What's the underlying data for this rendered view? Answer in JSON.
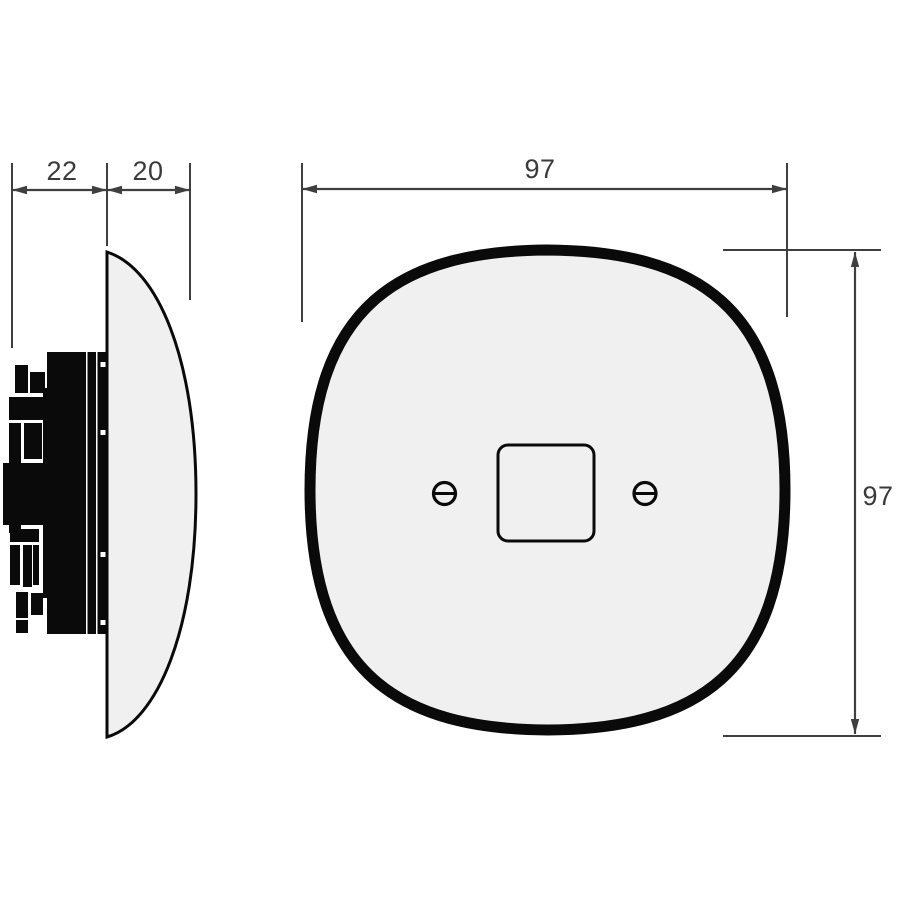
{
  "drawing": {
    "dimensions": {
      "side_depth_back": "22",
      "side_depth_plate": "20",
      "front_width": "97",
      "front_height": "97"
    }
  },
  "colors": {
    "background": "#ffffff",
    "plate_fill": "#f0f0f0",
    "outline": "#0a0a0a",
    "mechanism_fill": "#0a0a0a",
    "dim_line": "#3f3f3f",
    "dim_text": "#3a3a3a"
  }
}
